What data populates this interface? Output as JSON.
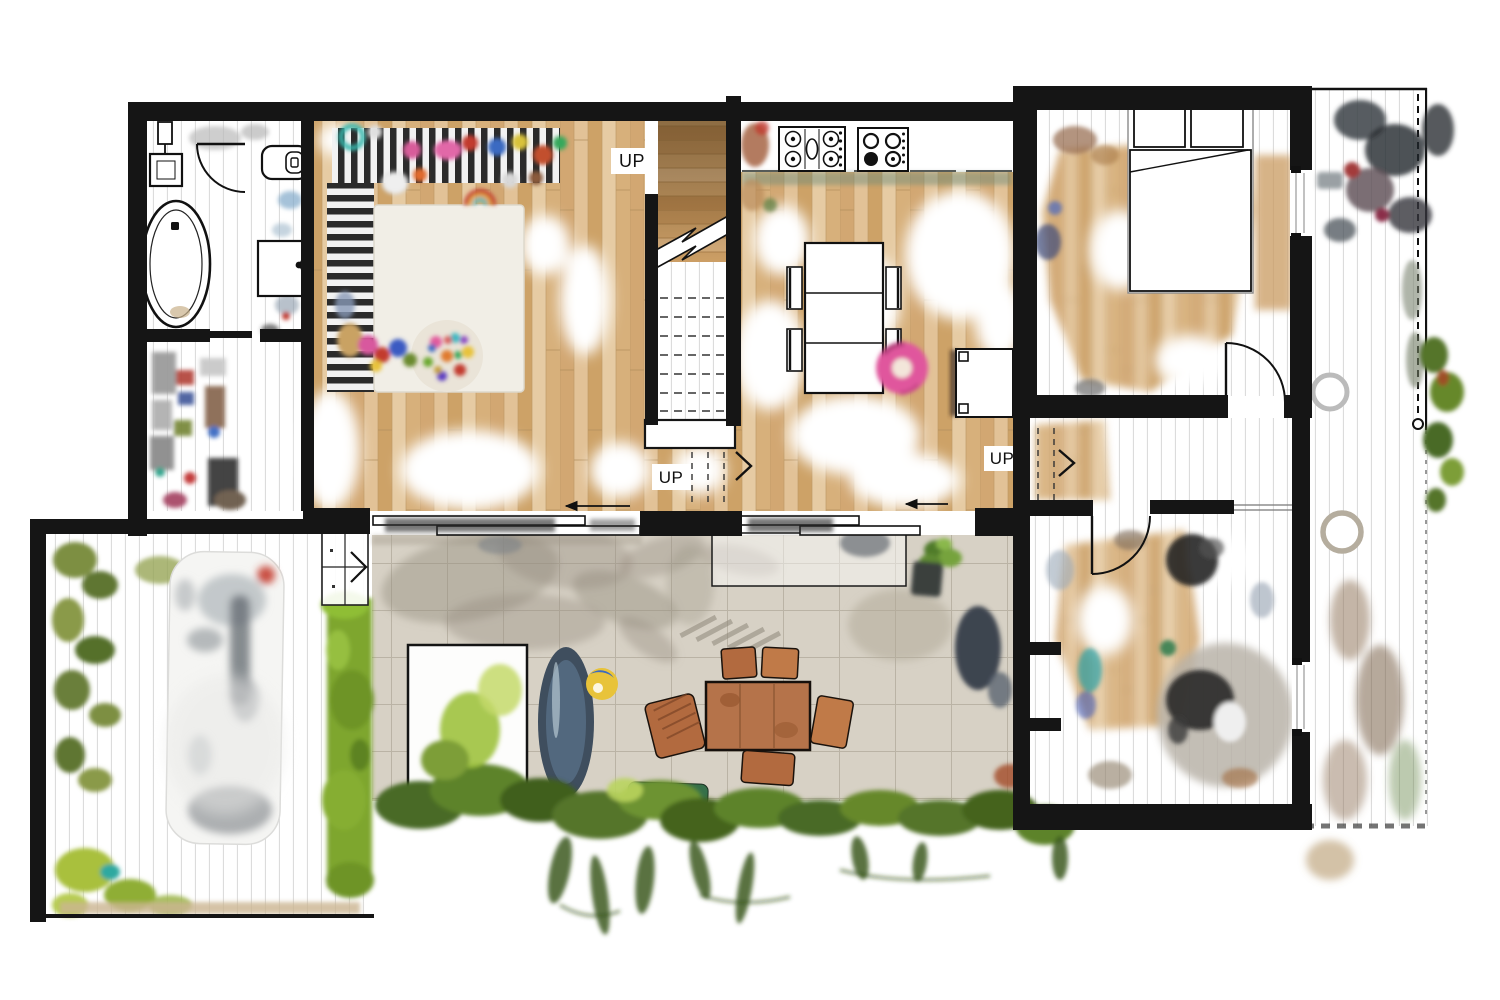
{
  "floorplan": {
    "labels": {
      "stair_upper": "UP",
      "stair_living_step": "UP",
      "stair_hall_step": "UP"
    },
    "colors": {
      "wall": "#151515",
      "wood_floor": "#dab684",
      "wood_floor_light": "#e6cba3",
      "scan_plank_line": "#d9d9d9",
      "paver_concrete": "#d7d1c5",
      "paver_line": "#bab3a5",
      "shadow": "#958d7f",
      "hedge_green": "#7ea62e",
      "foliage_dark": "#3c5a20",
      "trampoline_blue": "#3f4e5e",
      "outdoor_table_wood": "#b5734a",
      "pink_float": "#e0579d",
      "rug_stripe_black": "#2b2b2b",
      "play_mat": "#f1eee6",
      "bench_green": "#2e6b45"
    }
  }
}
